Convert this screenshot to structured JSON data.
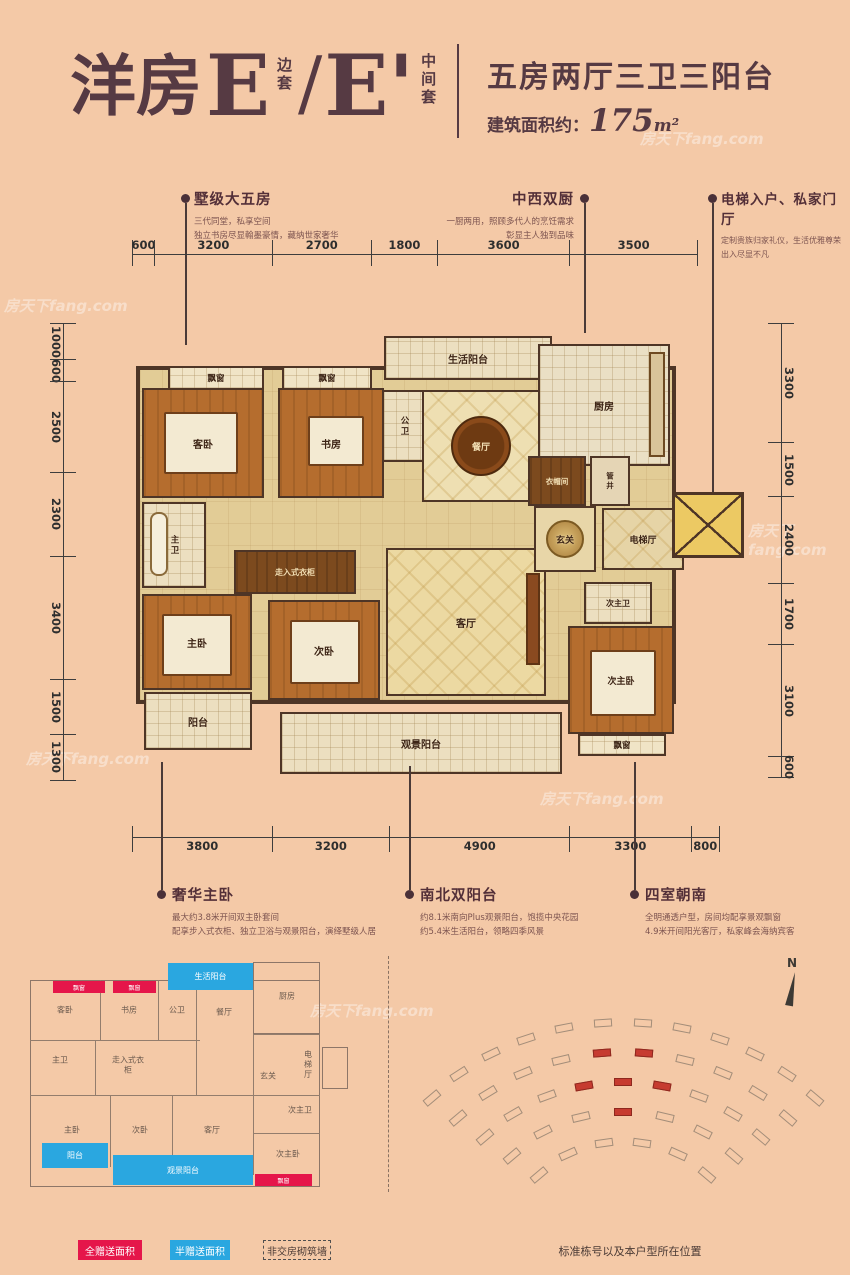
{
  "colors": {
    "background": "#f4c9a7",
    "title": "#563a43",
    "legend_red": "#e5164a",
    "legend_blue": "#2aa7e0"
  },
  "watermark": "房天下fang.com",
  "header": {
    "title_zh": "洋房",
    "title_letter": "E",
    "tag1_chars": [
      "边",
      "套"
    ],
    "slash": "/",
    "title_letter2": "E'",
    "tag2_chars": [
      "中",
      "间",
      "套"
    ],
    "spec_title": "五房两厅三卫三阳台",
    "area_label": "建筑面积约：",
    "area_value": "175",
    "area_unit": "m²"
  },
  "callouts_top": [
    {
      "title": "墅级大五房",
      "line1": "三代同堂，私享空间",
      "line2": "独立书房尽显翰墨豪情，藏纳世家奢华"
    },
    {
      "title": "中西双厨",
      "line1": "一厨两用，照顾多代人的烹饪需求",
      "line2": "彰显主人独到品味"
    },
    {
      "title": "电梯入户、私家门厅",
      "line1": "定制贵族归家礼仪，生活优雅尊荣",
      "line2": "出入尽显不凡"
    }
  ],
  "callouts_bottom": [
    {
      "title": "奢华主卧",
      "line1": "最大约3.8米开间双主卧套间",
      "line2": "配享步入式衣柜、独立卫浴与观景阳台，演绎墅级人居"
    },
    {
      "title": "南北双阳台",
      "line1": "约8.1米南向Plus观景阳台，饱揽中央花园",
      "line2": "约5.4米生活阳台，领略四季风景"
    },
    {
      "title": "四室朝南",
      "line1": "全明通透户型，房间均配享景观飘窗",
      "line2": "4.9米开间阳光客厅，私家峰会海纳宾客"
    }
  ],
  "dimensions": {
    "top": [
      "600",
      "3200",
      "2700",
      "1800",
      "3600",
      "3500"
    ],
    "bottom": [
      "3800",
      "3200",
      "4900",
      "3300",
      "800"
    ],
    "left": [
      "1000",
      "600",
      "2500",
      "2300",
      "3400",
      "1500",
      "1300"
    ],
    "right": [
      "3300",
      "1500",
      "2400",
      "1700",
      "3100",
      "600"
    ]
  },
  "plan": {
    "rooms": [
      "飘窗",
      "客卧",
      "飘窗",
      "书房",
      "公卫",
      "生活阳台",
      "厨房",
      "餐厅",
      "衣帽间",
      "管井",
      "主卫",
      "走入式衣柜",
      "主卧",
      "次卧",
      "客厅",
      "玄关",
      "电梯厅",
      "次主卫",
      "次主卧",
      "飘窗",
      "阳台",
      "观景阳台"
    ]
  },
  "mini": {
    "rooms": [
      "客卧",
      "书房",
      "公卫",
      "餐厅",
      "厨房",
      "主卫",
      "走入式衣柜",
      "玄关",
      "电梯厅",
      "主卧",
      "次卧",
      "客厅",
      "次主卫",
      "次主卧"
    ],
    "half_zones": [
      "生活阳台",
      "阳台",
      "观景阳台"
    ],
    "full_zones": [
      "飘窗",
      "飘窗",
      "飘窗"
    ]
  },
  "legend": [
    {
      "label": "全赠送面积"
    },
    {
      "label": "半赠送面积"
    },
    {
      "label": "非交房砌筑墙"
    }
  ],
  "site": {
    "caption": "标准栋号以及本户型所在位置",
    "north": "N"
  }
}
